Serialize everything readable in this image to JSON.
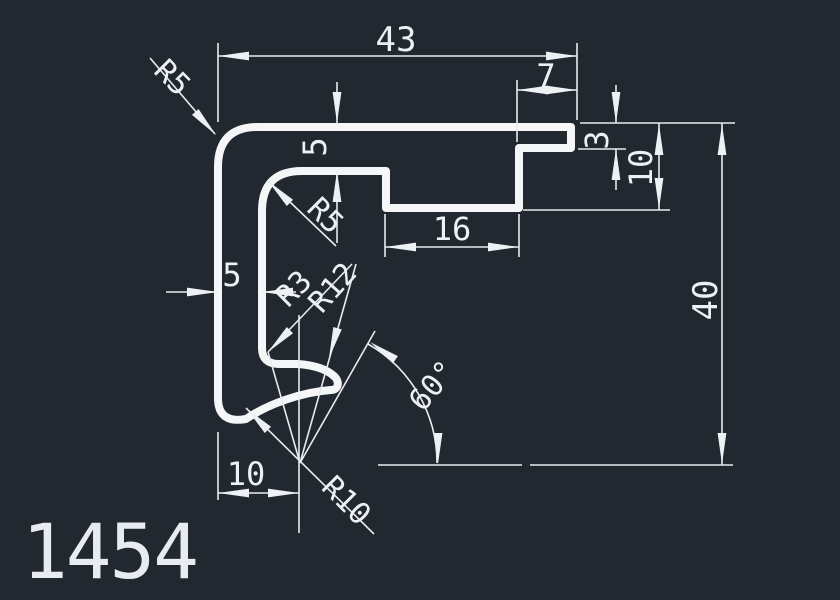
{
  "canvas": {
    "background": "#212830",
    "line_color": "#f5f6f7"
  },
  "drawing": {
    "part_number": "1454",
    "dims": {
      "overall_width": "43",
      "lip_width": "7",
      "top_wall_thickness": "5",
      "lip_thickness": "3",
      "arm_depth": "10",
      "notch_width": "16",
      "overall_height": "40",
      "left_wall_gap": "5",
      "hook_center_offset": "10",
      "hook_angle": "60°",
      "radius_outer_corner": "R5",
      "radius_inner_corner": "R5",
      "radius_hook_elbow": "R3",
      "radius_hook_inner": "R12",
      "radius_hook_outer": "R10"
    }
  }
}
